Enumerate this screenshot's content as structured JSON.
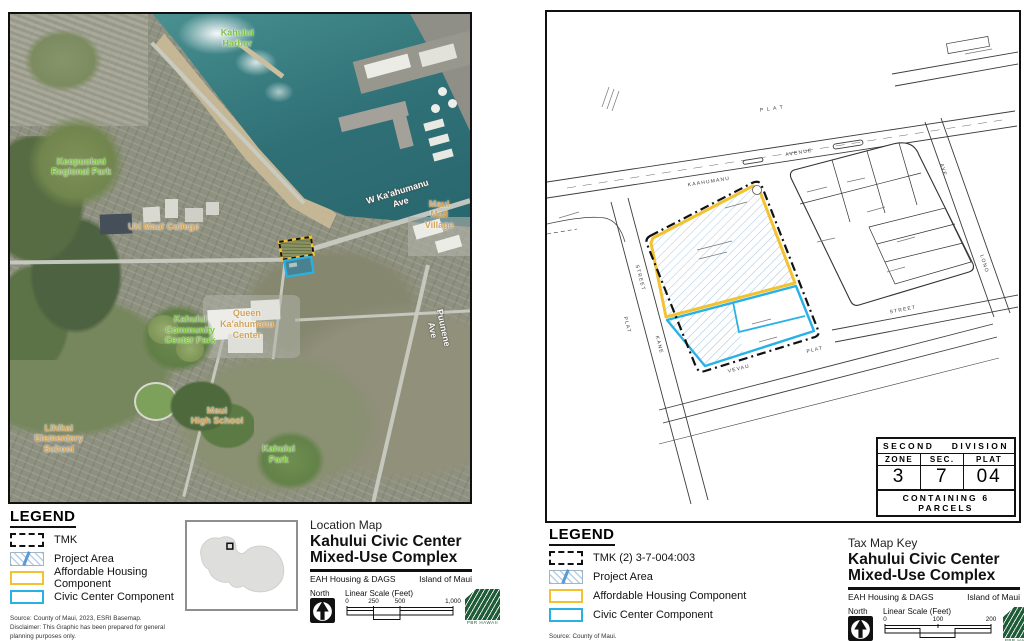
{
  "colors": {
    "affordable_yellow": "#F2C230",
    "civic_cyan": "#29B1E6",
    "hatch_blue": "#A5C4DE",
    "label_green": "#7CC242",
    "label_tan": "#D2A45C",
    "water_teal": "#2F7076",
    "logo_green": "#1E5C38"
  },
  "left": {
    "map": {
      "labels": [
        {
          "text": "Kahului\nHarbor",
          "style": "green",
          "x": 49.4,
          "y": 4.9,
          "rot": 0
        },
        {
          "text": "Keopuolani\nRegional Park",
          "style": "green",
          "x": 15.5,
          "y": 31.3,
          "rot": 0
        },
        {
          "text": "UH Maui College",
          "style": "tan",
          "x": 33.4,
          "y": 43.7,
          "rot": 0
        },
        {
          "text": "W Ka'ahumanu Ave",
          "style": "road-lbl",
          "x": 84.5,
          "y": 37.6,
          "rot": -17
        },
        {
          "text": "Maui Mall\nVillage",
          "style": "tan",
          "x": 93.3,
          "y": 41.1,
          "rot": 0
        },
        {
          "text": "Queen\nKa'ahumanu\nCenter",
          "style": "tan",
          "x": 51.5,
          "y": 63.6,
          "rot": 0
        },
        {
          "text": "Kahului\nCommunity\nCenter Park",
          "style": "green",
          "x": 39.2,
          "y": 64.8,
          "rot": 0
        },
        {
          "text": "Puunene Ave",
          "style": "road-lbl",
          "x": 93.1,
          "y": 64.6,
          "rot": 78
        },
        {
          "text": "Maui\nHigh School",
          "style": "tan",
          "x": 45.0,
          "y": 82.3,
          "rot": 0
        },
        {
          "text": "Lihikai\nElementary\nSchool",
          "style": "tan",
          "x": 10.6,
          "y": 87.0,
          "rot": 0
        },
        {
          "text": "Kahului\nPark",
          "style": "green",
          "x": 58.4,
          "y": 90.2,
          "rot": 0
        }
      ]
    },
    "legend": {
      "title": "LEGEND",
      "items": [
        {
          "swatch": "tmk",
          "label": "TMK"
        },
        {
          "swatch": "project",
          "label": "Project Area"
        },
        {
          "swatch": "affordable",
          "label": "Affordable Housing Component"
        },
        {
          "swatch": "civic",
          "label": "Civic Center Component"
        }
      ],
      "source": "Source: County of Maui, 2023, ESRI Basemap.",
      "disclaimer": "Disclaimer: This Graphic has been prepared for general planning purposes only."
    },
    "title_block": {
      "map_type": "Location Map",
      "title_line1": "Kahului Civic Center",
      "title_line2": "Mixed-Use Complex",
      "client": "EAH Housing & DAGS",
      "island": "Island of Maui",
      "north_label": "North",
      "scale_label": "Linear Scale (Feet)",
      "scale_ticks": [
        {
          "label": "0",
          "pos": 0
        },
        {
          "label": "250",
          "pos": 0.25
        },
        {
          "label": "500",
          "pos": 0.5
        },
        {
          "label": "1,000",
          "pos": 1
        }
      ],
      "logo_caption": "PBR HAWAII"
    }
  },
  "right": {
    "map": {
      "street_labels": [
        {
          "text": "P L A T",
          "x": 225,
          "y": 97,
          "rot": -8
        },
        {
          "text": "KAAHUMANU",
          "x": 162,
          "y": 170,
          "rot": -9
        },
        {
          "text": "AVENUE",
          "x": 252,
          "y": 141,
          "rot": -9
        },
        {
          "text": "STREET",
          "x": 93,
          "y": 266,
          "rot": 75
        },
        {
          "text": "PLAT",
          "x": 80,
          "y": 313,
          "rot": 75
        },
        {
          "text": "KANE",
          "x": 112,
          "y": 333,
          "rot": 75
        },
        {
          "text": "AVE",
          "x": 396,
          "y": 158,
          "rot": 73
        },
        {
          "text": "LONO",
          "x": 437,
          "y": 252,
          "rot": 73
        },
        {
          "text": "STREET",
          "x": 356,
          "y": 298,
          "rot": -11
        },
        {
          "text": "VEVAU",
          "x": 192,
          "y": 357,
          "rot": -14
        },
        {
          "text": "PLAT",
          "x": 268,
          "y": 338,
          "rot": -14
        }
      ]
    },
    "division_box": {
      "row1_left": "SECOND",
      "row1_right": "DIVISION",
      "cols": [
        "ZONE",
        "SEC.",
        "PLAT"
      ],
      "values": [
        "3",
        "7",
        "04"
      ],
      "footer": "CONTAINING 6 PARCELS"
    },
    "legend": {
      "title": "LEGEND",
      "items": [
        {
          "swatch": "tmk",
          "label": "TMK  (2) 3-7-004:003"
        },
        {
          "swatch": "project",
          "label": "Project Area"
        },
        {
          "swatch": "affordable",
          "label": "Affordable Housing Component"
        },
        {
          "swatch": "civic",
          "label": "Civic Center Component"
        }
      ],
      "source": "Source: County of Maui.",
      "disclaimer": "Disclaimer: This Graphic has been prepared for general planning purposes only."
    },
    "title_block": {
      "map_type": "Tax Map Key",
      "title_line1": "Kahului Civic Center",
      "title_line2": "Mixed-Use Complex",
      "client": "EAH Housing & DAGS",
      "island": "Island of Maui",
      "north_label": "North",
      "scale_label": "Linear Scale (Feet)",
      "scale_ticks": [
        {
          "label": "0",
          "pos": 0
        },
        {
          "label": "100",
          "pos": 0.5
        },
        {
          "label": "200",
          "pos": 1
        }
      ],
      "logo_caption": "PBR HAWAII"
    }
  }
}
